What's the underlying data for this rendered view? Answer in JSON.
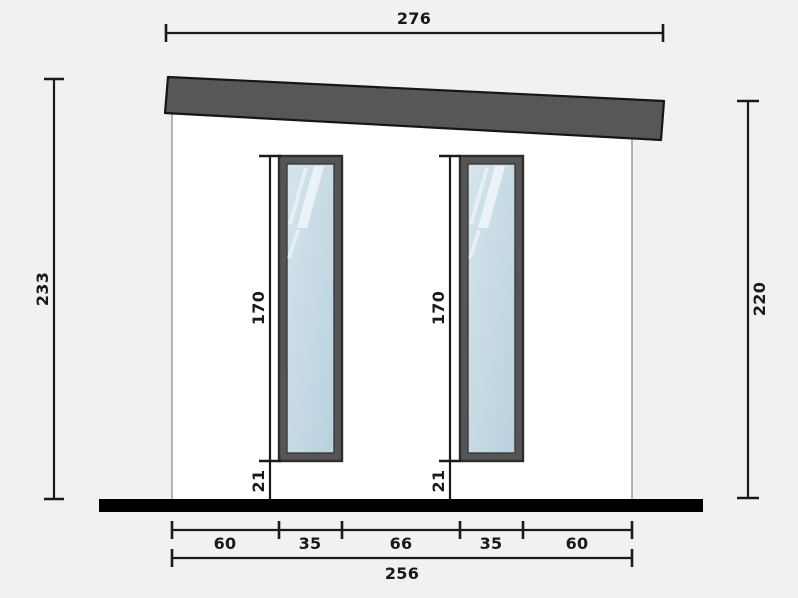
{
  "drawing": {
    "type": "elevation-diagram",
    "dimensions": {
      "roof_width": "276",
      "left_height": "233",
      "right_height": "220",
      "window_height": "170",
      "window_sill": "21",
      "total_width": "256",
      "bottom_segments": [
        "60",
        "35",
        "66",
        "35",
        "60"
      ]
    },
    "colors": {
      "background": "#f1f1f1",
      "wall": "#ffffff",
      "wall_outline": "#8f8f8f",
      "roof": "#575757",
      "roof_outline": "#161616",
      "window_frame": "#555555",
      "window_frame_outline": "#2e2e2e",
      "glass": "#c4dae4",
      "floor": "#000000",
      "dimension_lines": "#1a1a1a"
    }
  }
}
